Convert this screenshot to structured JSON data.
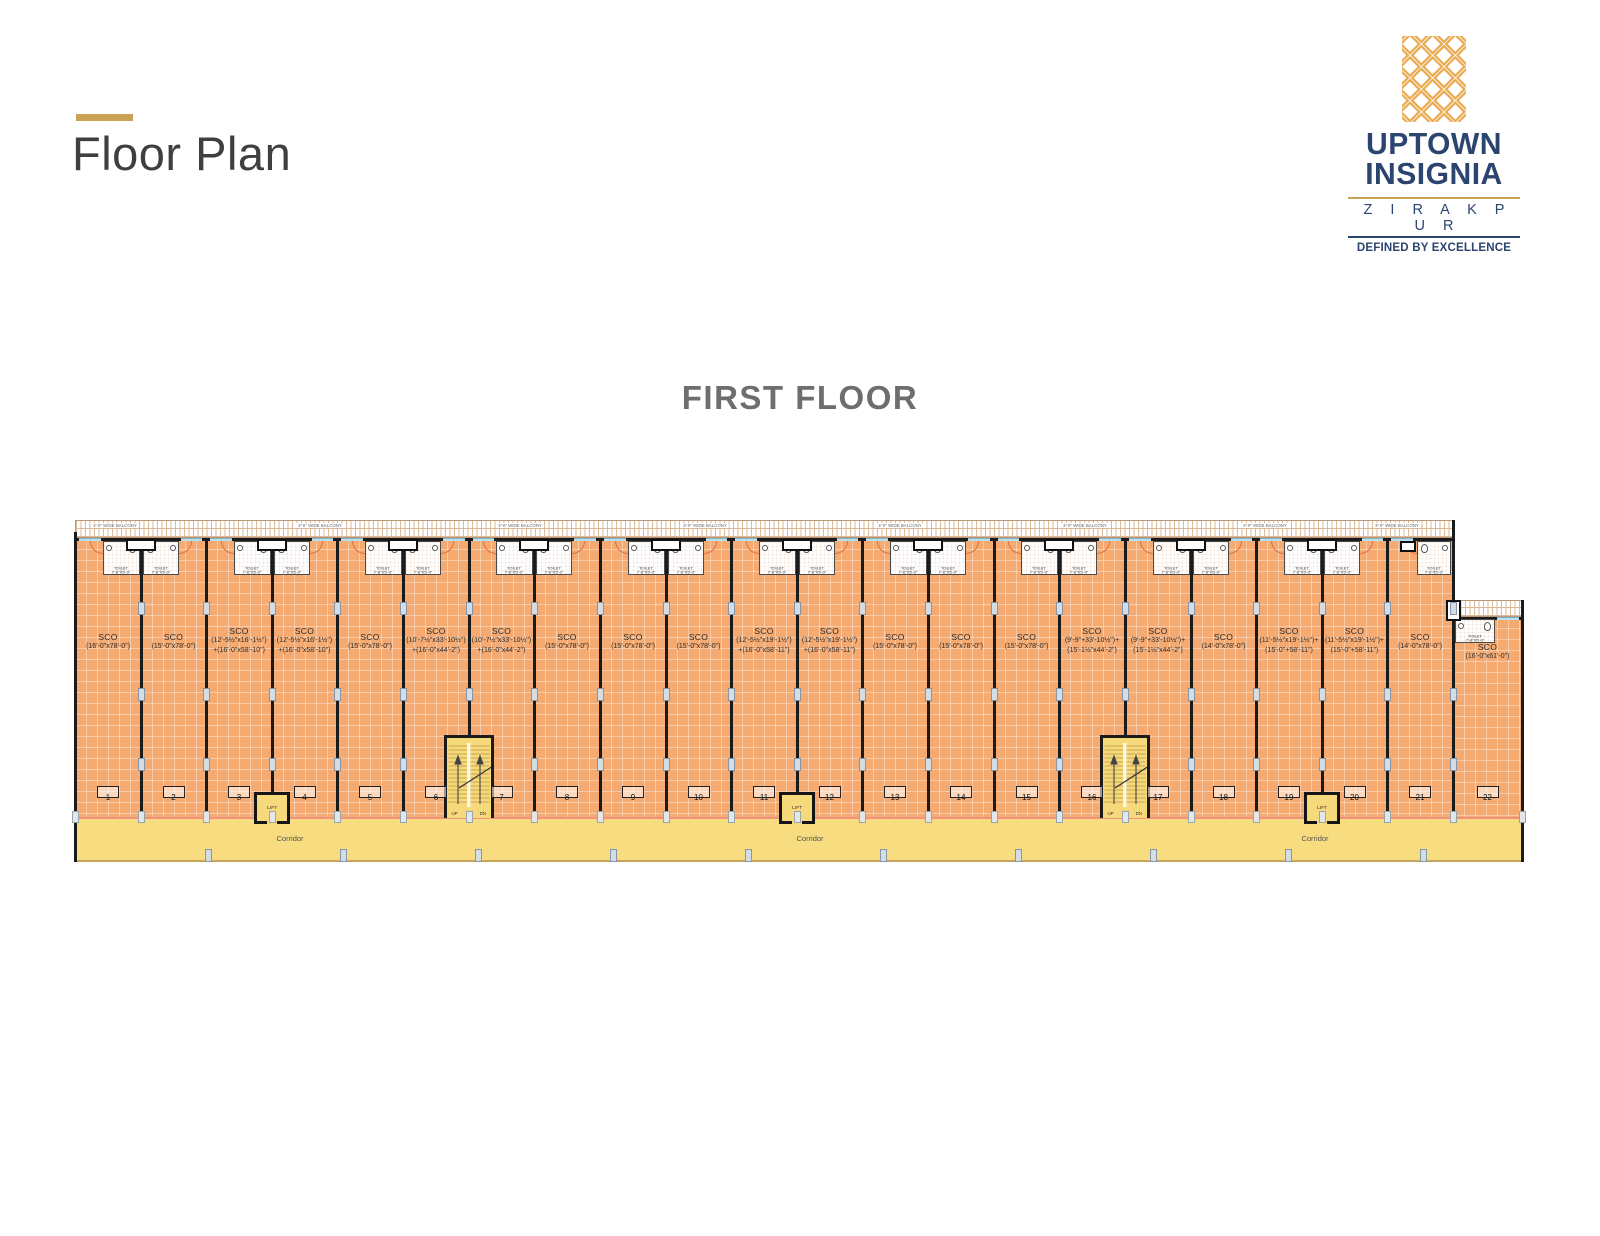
{
  "header": {
    "title": "Floor Plan"
  },
  "logo": {
    "brand_line1": "UPTOWN",
    "brand_line2": "INSIGNIA",
    "location": "Z I R A K P U R",
    "tagline": "DEFINED BY EXCELLENCE"
  },
  "floor": {
    "title": "FIRST FLOOR"
  },
  "plan": {
    "unit_type": "SCO",
    "balcony_label": "3'-0\" WIDE BALCONY",
    "toilet_line1": "TOILET",
    "toilet_line2": "7'-6\"X5'-0\"",
    "corridor_label": "Corridor",
    "lift_label": "LIFT",
    "up_label": "UP",
    "dn_label": "DN",
    "units": [
      {
        "no": "1",
        "dims": [
          "(16'-0\"x78'-0\")"
        ]
      },
      {
        "no": "2",
        "dims": [
          "(15'-0\"x78'-0\")"
        ]
      },
      {
        "no": "3",
        "dims": [
          "(12'-5½\"x16'-1½\")",
          "+(16'-0\"x58'-10\")"
        ]
      },
      {
        "no": "4",
        "dims": [
          "(12'-5½\"x16'-1½\")",
          "+(16'-0\"x58'-10\")"
        ]
      },
      {
        "no": "5",
        "dims": [
          "(15'-0\"x78'-0\")"
        ]
      },
      {
        "no": "6",
        "dims": [
          "(10'-7½\"x33'-10½\")",
          "+(16'-0\"x44'-2\")"
        ]
      },
      {
        "no": "7",
        "dims": [
          "(10'-7½\"x33'-10½\")",
          "+(16'-0\"x44'-2\")"
        ]
      },
      {
        "no": "8",
        "dims": [
          "(15'-0\"x78'-0\")"
        ]
      },
      {
        "no": "9",
        "dims": [
          "(15'-0\"x78'-0\")"
        ]
      },
      {
        "no": "10",
        "dims": [
          "(15'-0\"x78'-0\")"
        ]
      },
      {
        "no": "11",
        "dims": [
          "(12'-5½\"x19'-1½\")",
          "+(16'-0\"x58'-11\")"
        ]
      },
      {
        "no": "12",
        "dims": [
          "(12'-5½\"x19'-1½\")",
          "+(16'-0\"x58'-11\")"
        ]
      },
      {
        "no": "13",
        "dims": [
          "(15'-0\"x78'-0\")"
        ]
      },
      {
        "no": "14",
        "dims": [
          "(15'-0\"x78'-0\")"
        ]
      },
      {
        "no": "15",
        "dims": [
          "(15'-0\"x78'-0\")"
        ]
      },
      {
        "no": "16",
        "dims": [
          "(9'-9\"+33'-10½\")+",
          "(15'-1½\"x44'-2\")"
        ]
      },
      {
        "no": "17",
        "dims": [
          "(9'-9\"+33'-10½\")+",
          "(15'-1½\"x44'-2\")"
        ]
      },
      {
        "no": "18",
        "dims": [
          "(14'-0\"x78'-0\")"
        ]
      },
      {
        "no": "19",
        "dims": [
          "(11'-5½\"x19'-1½\")+",
          "(15'-0\"+58'-11\")"
        ]
      },
      {
        "no": "20",
        "dims": [
          "(11'-5½\"x19'-1½\")+",
          "(15'-0\"+58'-11\")"
        ]
      },
      {
        "no": "21",
        "dims": [
          "(14'-0\"x78'-0\")"
        ]
      },
      {
        "no": "22",
        "dims": [
          "(16'-0\"x61'-0\")"
        ]
      }
    ]
  },
  "colors": {
    "accent_gold": "#C9A254",
    "brand_navy": "#2B4470",
    "logo_orange": "#E9A94E",
    "unit_fill": "#F4AA71",
    "corridor_fill": "#F8DC80",
    "stair_lift_fill": "#F6D97B",
    "plinth_line": "#F2917E"
  }
}
